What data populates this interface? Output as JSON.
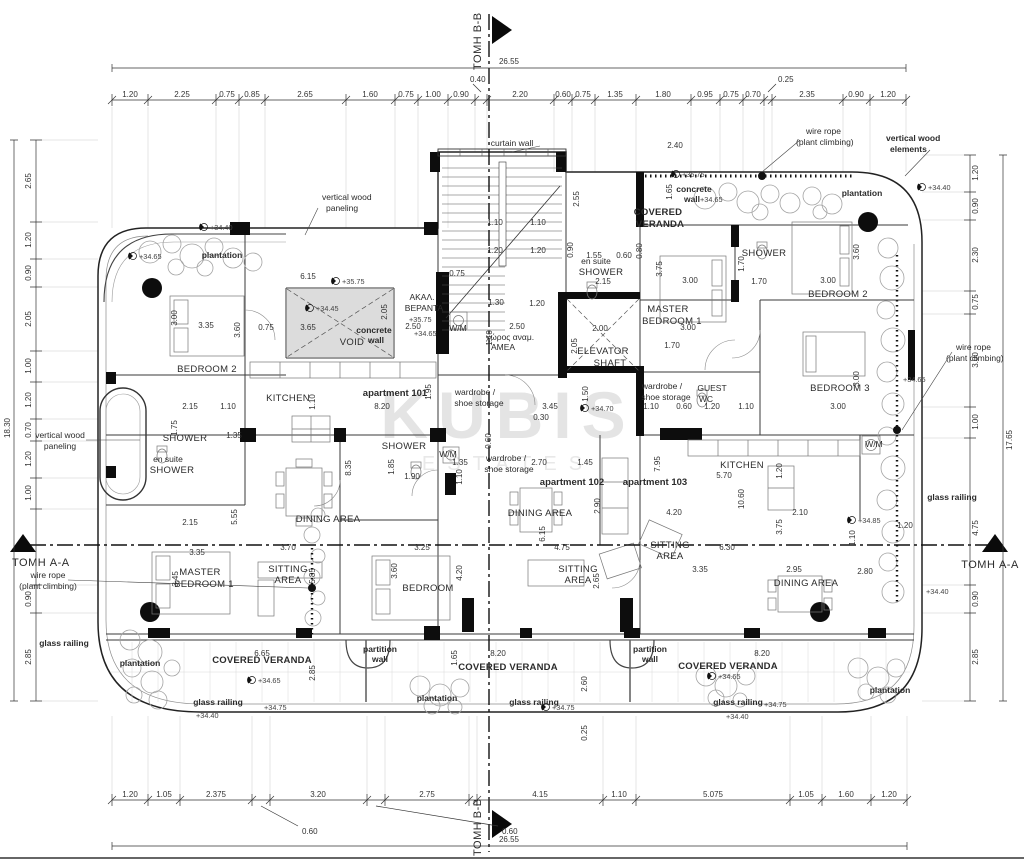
{
  "watermark": {
    "line1": "KUBIS",
    "line2": "ESTATES"
  },
  "sections": {
    "aa": "ΤΟΜΗ A-A",
    "bb": "ΤΟΜΗ B-B"
  },
  "apartments": {
    "a101": "apartment 101",
    "a102": "apartment 102",
    "a103": "apartment 103"
  },
  "rooms": {
    "bedroom2": "BEDROOM 2",
    "bedroom3": "BEDROOM 3",
    "bedroom": "BEDROOM",
    "master1": "MASTER",
    "master2": "BEDROOM 1",
    "kitchen": "KITCHEN",
    "shower": "SHOWER",
    "ensuite": "en suite",
    "dining": "DINING AREA",
    "sitting1": "SITTING",
    "sitting2": "AREA",
    "void": "VOID",
    "elev1": "ELEVATOR",
    "elev2": "SHAFT",
    "guest1": "GUEST",
    "guest2": "WC",
    "wm": "W/M",
    "wardrobe1": "wardrobe /",
    "wardrobe2": "shoe storage",
    "akal1": "ΑΚΑΛ.",
    "akal2": "ΒΕΡΑΝΤΑ",
    "amea1": "χώρος αναμ.",
    "amea2": "ΑΜΕΑ",
    "covered": "COVERED VERANDA",
    "covered1": "COVERED",
    "covered2": "VERANDA"
  },
  "annotations": {
    "curtain_wall": "curtain wall",
    "concrete1": "concrete",
    "concrete2": "wall",
    "vwp1": "vertical wood",
    "vwp2": "paneling",
    "vwe1": "vertical wood",
    "vwe2": "elements",
    "wire1": "wire rope",
    "wire2": "(plant climbing)",
    "plantation": "plantation",
    "glass": "glass railing",
    "partition1": "partition",
    "partition2": "wall"
  },
  "levels": {
    "l3440": "+34.40",
    "l3445": "+34.45",
    "l3465": "+34.65",
    "l3470": "+34.70",
    "l3475": "+34.75",
    "l3485": "+34.85",
    "l3575": "+35.75"
  },
  "dims": {
    "overall_top": "26.55",
    "overall_bottom": "26.55",
    "overall_left": "18.30",
    "overall_right": "17.65",
    "top": [
      "1.20",
      "2.25",
      "0.75",
      "0.85",
      "2.65",
      "1.60",
      "0.75",
      "1.00",
      "0.90",
      "2.20",
      "0.60",
      "0.75",
      "1.35",
      "1.80",
      "0.95",
      "0.75",
      "0.70",
      "2.35",
      "0.90",
      "1.20"
    ],
    "top_callouts": [
      "0.40",
      "0.25"
    ],
    "bottom": [
      "1.20",
      "1.05",
      "2.375",
      "3.20",
      "2.75",
      "4.15",
      "1.10",
      "5.075",
      "1.05",
      "1.60",
      "1.20"
    ],
    "bottom_callouts": [
      "0.60",
      "0.60"
    ],
    "left": [
      "2.65",
      "1.20",
      "0.90",
      "2.05",
      "1.00",
      "1.20",
      "0.70",
      "1.20",
      "1.00",
      "0.90",
      "2.85"
    ],
    "right": [
      "1.20",
      "0.90",
      "2.30",
      "0.75",
      "3.00",
      "1.00",
      "4.75",
      "0.90",
      "2.85"
    ]
  },
  "pd": [
    "6.15",
    "0.75",
    "3.65",
    "2.05",
    "3.35",
    "3.00",
    "3.60",
    "2.15",
    "1.10",
    "1.75",
    "1.35",
    "8.20",
    "1.95",
    "1.10",
    "2.50",
    "2.50",
    "1.10",
    "1.20",
    "1.30",
    "2.00",
    "2.05",
    "1.50",
    "1.55",
    "0.60",
    "2.15",
    "0.90",
    "0.80",
    "3.00",
    "3.75",
    "3.00",
    "1.70",
    "1.70",
    "1.70",
    "3.00",
    "3.60",
    "3.00",
    "3.00",
    "1.20",
    "1.10",
    "0.60",
    "1.10",
    "3.45",
    "0.30",
    "2.55",
    "1.10",
    "1.10",
    "1.20",
    "1.20",
    "0.75",
    "2.40",
    "1.65",
    "7.95",
    "5.70",
    "10.60",
    "1.20",
    "4.20",
    "2.10",
    "3.75",
    "6.30",
    "3.35",
    "2.95",
    "2.80",
    "1.10",
    "2.70",
    "1.45",
    "2.90",
    "6.15",
    "4.75",
    "2.65",
    "0.60",
    "1.35",
    "1.10",
    "1.85",
    "1.90",
    "3.25",
    "3.60",
    "4.20",
    "8.35",
    "5.55",
    "2.15",
    "3.35",
    "3.70",
    "5.85",
    "3.45",
    "6.65",
    "2.85",
    "8.20",
    "1.65",
    "8.20",
    "1.20",
    "0.25",
    "2.60"
  ]
}
